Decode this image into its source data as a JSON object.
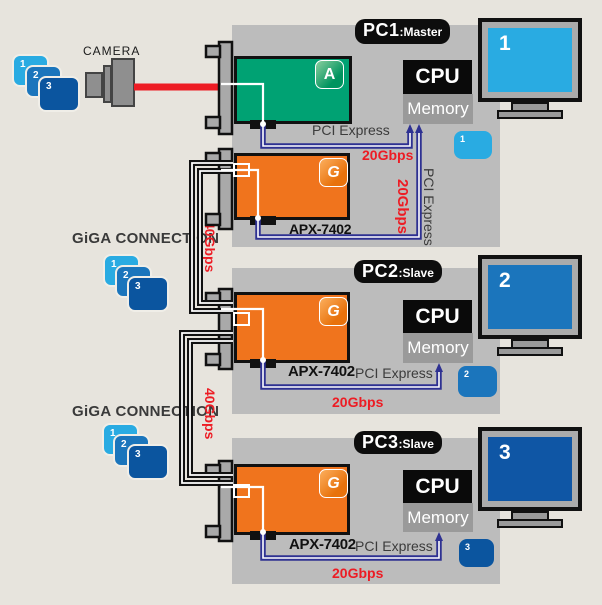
{
  "colors": {
    "background": "#E7E4DD",
    "panel": "#BCBCBC",
    "board_green": "#00A273",
    "board_orange": "#F0741D",
    "cable_red": "#ED1C24",
    "cable_navy": "#2E3192",
    "cable_black": "#111111",
    "blue_1": "#29ABE2",
    "blue_2": "#1B75BC",
    "blue_3": "#0B559F",
    "cpu_black": "#0A0A0A",
    "memory_gray": "#9A9A9A"
  },
  "camera": {
    "label": "CAMERA"
  },
  "source_objects": {
    "items": [
      "1",
      "2",
      "3"
    ]
  },
  "giga_connections": [
    {
      "label": "GiGA CONNECTION",
      "items": [
        "1",
        "2",
        "3"
      ],
      "bandwidth": "40Gbps"
    },
    {
      "label": "GiGA CONNECTION",
      "items": [
        "1",
        "2",
        "3"
      ],
      "bandwidth": "40Gbps"
    }
  ],
  "pcs": [
    {
      "name": "PC1",
      "role": "Master",
      "cpu": "CPU",
      "memory": "Memory",
      "green_board": {
        "logo": "A"
      },
      "board": {
        "model": "APX-7402",
        "logo": "G"
      },
      "pci_label_h": "PCI Express",
      "bandwidth_h": "20Gbps",
      "pci_label_v": "PCI Express",
      "bandwidth_v": "20Gbps",
      "tag": "1",
      "monitor": "1"
    },
    {
      "name": "PC2",
      "role": "Slave",
      "cpu": "CPU",
      "memory": "Memory",
      "board": {
        "model": "APX-7402",
        "logo": "G"
      },
      "pci_label_h": "PCI Express",
      "bandwidth_h": "20Gbps",
      "tag": "2",
      "monitor": "2"
    },
    {
      "name": "PC3",
      "role": "Slave",
      "cpu": "CPU",
      "memory": "Memory",
      "board": {
        "model": "APX-7402",
        "logo": "G"
      },
      "pci_label_h": "PCI Express",
      "bandwidth_h": "20Gbps",
      "tag": "3",
      "monitor": "3"
    }
  ]
}
